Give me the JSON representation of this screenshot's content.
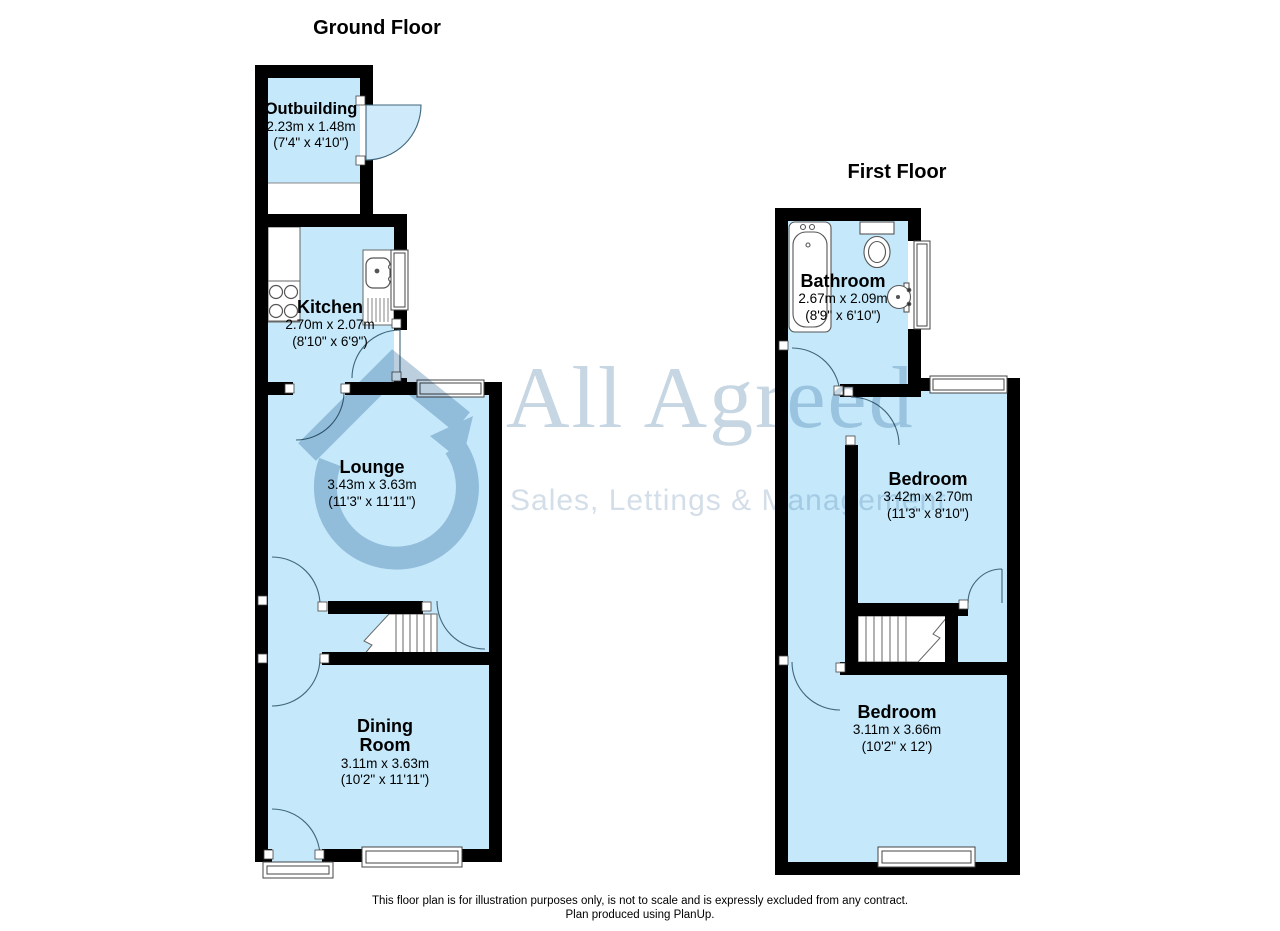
{
  "ground_floor": {
    "title": "Ground Floor",
    "rooms": [
      {
        "name": "Outbuilding",
        "dim_metric": "2.23m x 1.48m",
        "dim_imperial": "(7'4\" x 4'10\")"
      },
      {
        "name": "Kitchen",
        "dim_metric": "2.70m x 2.07m",
        "dim_imperial": "(8'10\" x 6'9\")"
      },
      {
        "name": "Lounge",
        "dim_metric": "3.43m x 3.63m",
        "dim_imperial": "(11'3\" x 11'11\")"
      },
      {
        "name": "Dining Room",
        "dim_metric": "3.11m x 3.63m",
        "dim_imperial": "(10'2\" x 11'11\")"
      }
    ]
  },
  "first_floor": {
    "title": "First Floor",
    "rooms": [
      {
        "name": "Bathroom",
        "dim_metric": "2.67m x 2.09m",
        "dim_imperial": "(8'9\" x 6'10\")"
      },
      {
        "name": "Bedroom",
        "dim_metric": "3.42m x 2.70m",
        "dim_imperial": "(11'3\" x 8'10\")"
      },
      {
        "name": "Bedroom",
        "dim_metric": "3.11m x 3.66m",
        "dim_imperial": "(10'2\" x 12')"
      }
    ]
  },
  "watermark": {
    "brand": "All Agreed",
    "tagline": "Sales, Lettings & Management"
  },
  "footer": {
    "line1": "This floor plan is for illustration purposes only, is not to scale and is expressly excluded from any contract.",
    "line2": "Plan produced using PlanUp."
  },
  "colors": {
    "room_fill": "#c5e9fb",
    "wall": "#000000",
    "door_arc": "#40667a",
    "watermark": "#bccfdf",
    "background": "#ffffff"
  }
}
